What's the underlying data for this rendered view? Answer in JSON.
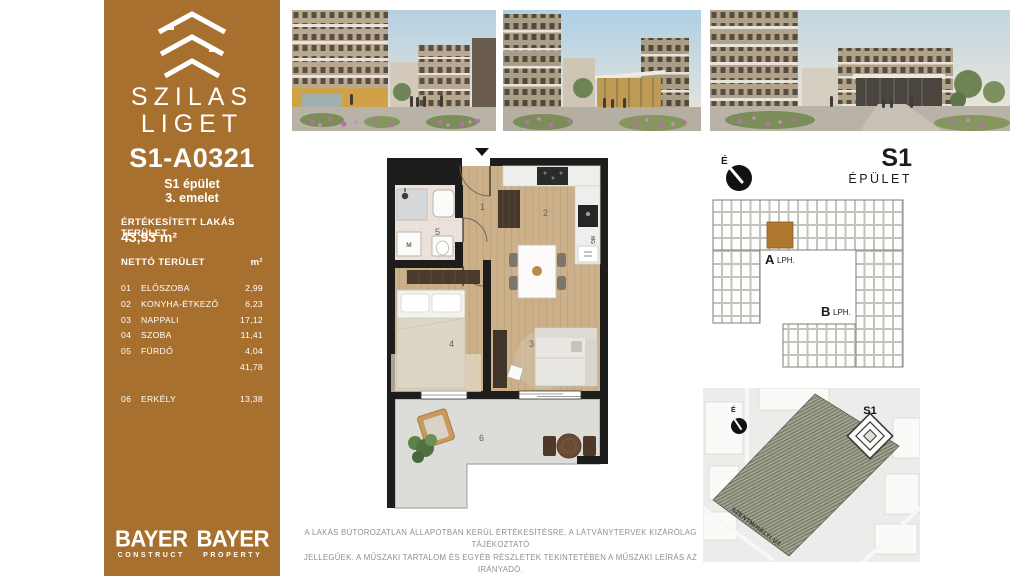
{
  "sidebar": {
    "accent_color": "#A8702F",
    "brand_line1": "SZILAS",
    "brand_line2": "LIGET",
    "unit_id": "S1-A0321",
    "building": "S1 épület",
    "floor": "3. emelet",
    "sold_area_label": "ÉRTÉKESÍTETT LAKÁS TERÜLET",
    "sold_area_value": "43,93 m²",
    "net_area_label": "NETTÓ TERÜLET",
    "net_area_unit": "m²",
    "rooms": [
      {
        "no": "01",
        "name": "ELŐSZOBA",
        "area": "2,99"
      },
      {
        "no": "02",
        "name": "KONYHA-ÉTKEZŐ",
        "area": "6,23"
      },
      {
        "no": "03",
        "name": "NAPPALI",
        "area": "17,12"
      },
      {
        "no": "04",
        "name": "SZOBA",
        "area": "11,41"
      },
      {
        "no": "05",
        "name": "FÜRDŐ",
        "area": "4,04"
      }
    ],
    "net_total": "41,78",
    "balcony_row": {
      "no": "06",
      "name": "ERKÉLY",
      "area": "13,38"
    },
    "brand_logos": [
      {
        "title": "BAYER",
        "subtitle": "CONSTRUCT"
      },
      {
        "title": "BAYER",
        "subtitle": "PROPERTY"
      }
    ]
  },
  "floor_plan": {
    "room_numbers": {
      "hallway": "1",
      "kitchen": "2",
      "living": "3",
      "bedroom": "4",
      "bathroom": "5",
      "balcony": "6"
    },
    "washer_label": "M",
    "dishwasher_label": "MG",
    "wall_color": "#1D1D1B",
    "wood_floor_color": "#CBB08A",
    "bath_floor_color": "#ECE2DB",
    "balcony_floor_color": "#DCDCD8"
  },
  "building_panel": {
    "north_label": "É",
    "building_code": "S1",
    "building_code_sub": "ÉPÜLET",
    "staircase_a": "A",
    "staircase_a_sub": "LPH.",
    "staircase_b": "B",
    "staircase_b_sub": "LPH.",
    "highlight_color": "#B0772F"
  },
  "site_map": {
    "north_label": "É",
    "building_label": "S1",
    "street_name": "SZENTMIHÁLYI ÚT"
  },
  "disclaimer": {
    "line1": "A LAKÁS BÚTOROZATLAN ÁLLAPOTBAN KERÜL ÉRTÉKESÍTÉSRE. A LÁTVÁNYTERVEK KIZÁRÓLAG TÁJÉKOZTATÓ",
    "line2": "JELLEGŰEK. A MŰSZAKI TARTALOM ÉS EGYÉB RÉSZLETEK TEKINTETÉBEN A MŰSZAKI LEÍRÁS AZ IRÁNYADÓ."
  }
}
